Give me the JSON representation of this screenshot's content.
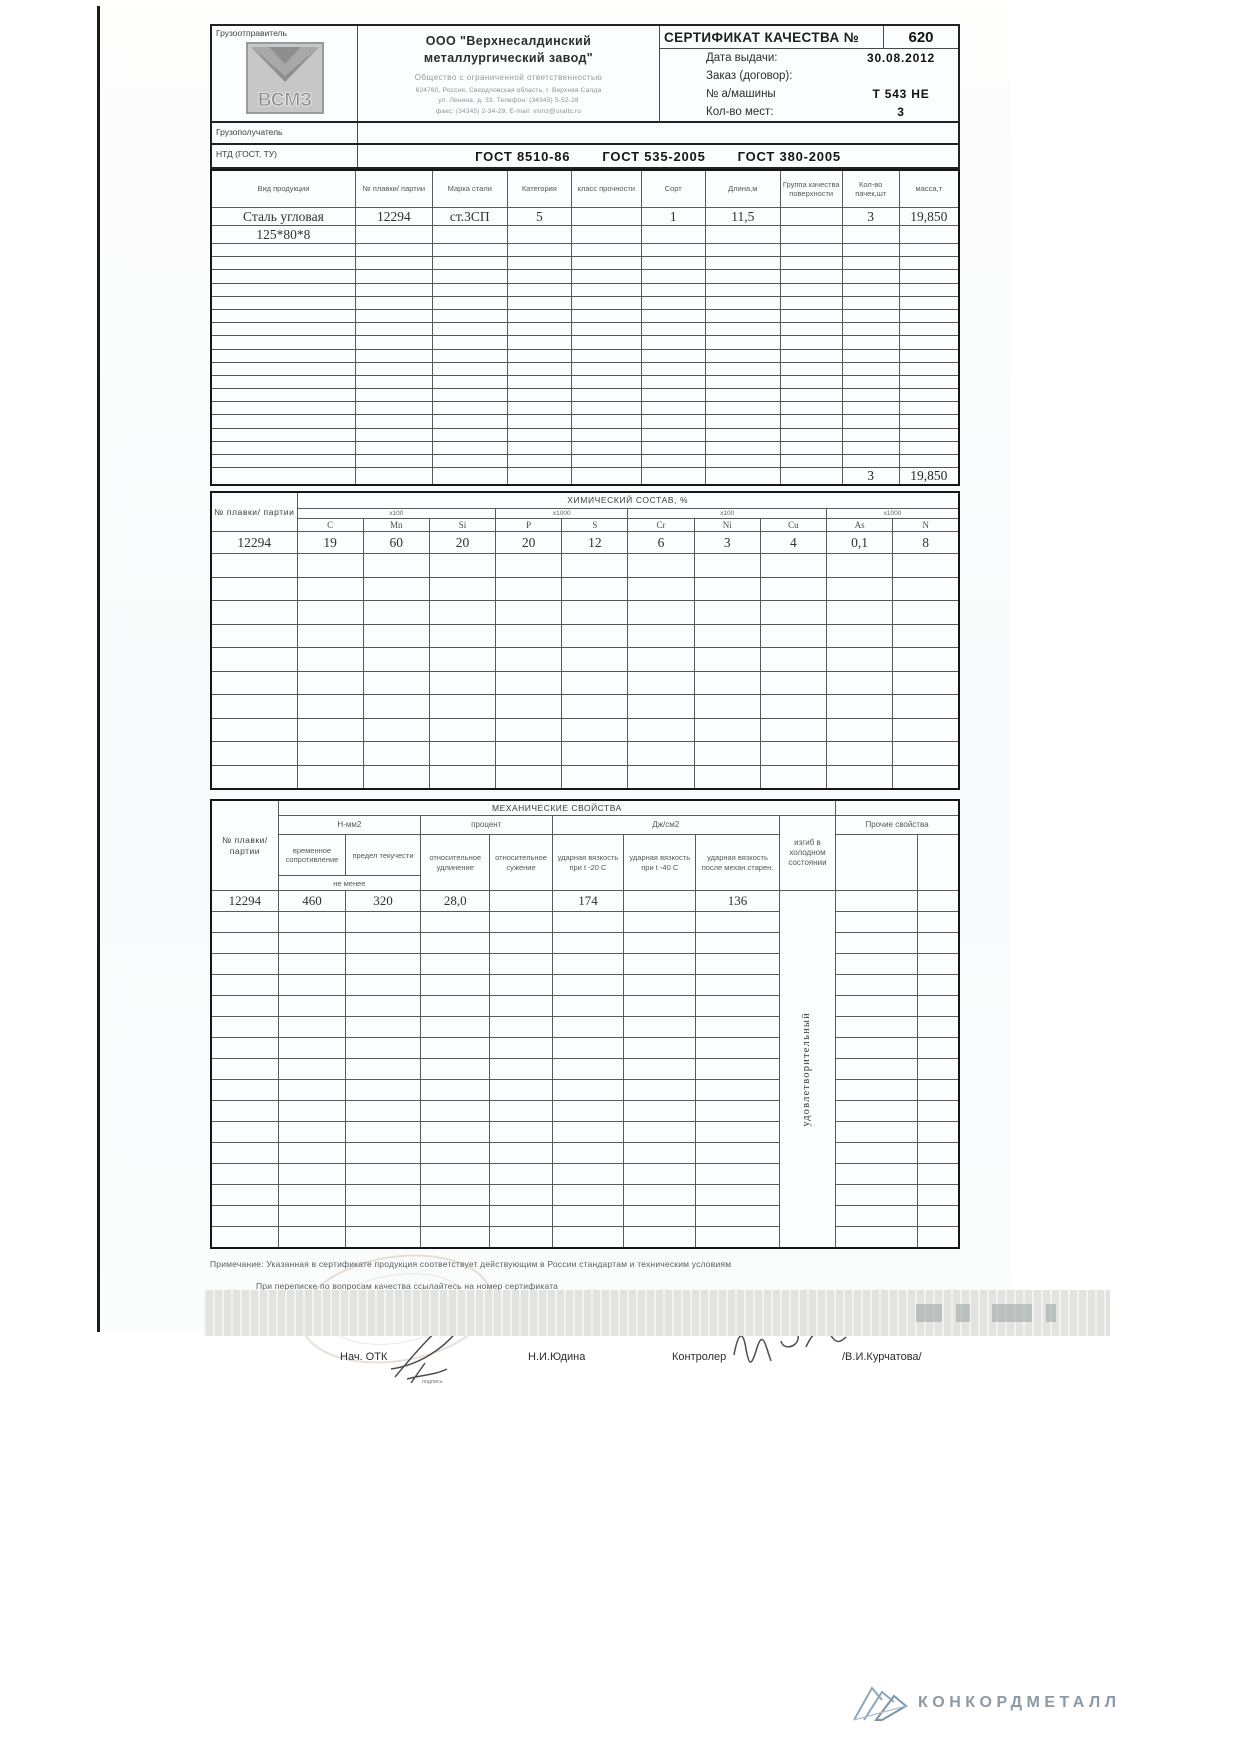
{
  "document": {
    "shipper_label": "Грузоотправитель",
    "logo_text": "ВСМЗ",
    "company": {
      "name1": "ООО \"Верхнесалдинский",
      "name2": "металлургический завод\"",
      "type": "Общество с ограниченной ответственностью",
      "addr1": "624760, Россия, Свердловская область, г. Верхняя Салда",
      "addr2": "ул. Ленина, д. 33. Телефон: (34345) 5-52-28",
      "addr3": "факс: (34345) 2-34-29, E-mail: vsmz@uraltc.ru"
    },
    "cert_title": "СЕРТИФИКАТ КАЧЕСТВА №",
    "cert_number": "620",
    "fields": [
      {
        "label": "Дата выдачи:",
        "value": "30.08.2012"
      },
      {
        "label": "Заказ (договор):",
        "value": ""
      },
      {
        "label": "№ а/машины",
        "value": "Т 543 НЕ"
      },
      {
        "label": "Кол-во мест:",
        "value": "3"
      }
    ],
    "consignee_label": "Грузополучатель",
    "ntd_label": "НТД (ГОСТ, ТУ)",
    "standards": [
      "ГОСТ 8510-86",
      "ГОСТ 535-2005",
      "ГОСТ 380-2005"
    ]
  },
  "product_table": {
    "columns": [
      "Вид продукции",
      "№ плавки/ партии",
      "Марка стали",
      "Категория",
      "класс прочности",
      "Сорт",
      "Длина,м",
      "Группа качества поверхности",
      "Кол-во пачек,шт",
      "масса,т"
    ],
    "rows": [
      [
        "Сталь угловая",
        "12294",
        "ст.3СП",
        "5",
        "",
        "1",
        "11,5",
        "",
        "3",
        "19,850"
      ],
      [
        "125*80*8",
        "",
        "",
        "",
        "",
        "",
        "",
        "",
        "",
        ""
      ]
    ],
    "empty_row_count": 17,
    "totals": {
      "packs": "3",
      "mass": "19,850"
    }
  },
  "chem_table": {
    "id_label": "№ плавки/ партии",
    "title": "ХИМИЧЕСКИЙ СОСТАВ, %",
    "groups": [
      "х100",
      "х1000",
      "х100",
      "х1000"
    ],
    "elements": [
      "C",
      "Mn",
      "Si",
      "P",
      "S",
      "Cr",
      "Ni",
      "Cu",
      "As",
      "N"
    ],
    "rows": [
      [
        "12294",
        "19",
        "60",
        "20",
        "20",
        "12",
        "6",
        "3",
        "4",
        "0,1",
        "8"
      ]
    ],
    "empty_row_count": 10
  },
  "mech_table": {
    "title": "МЕХАНИЧЕСКИЕ СВОЙСТВА",
    "id_label": "№ плавки/ партии",
    "group_nmm2": "Н-мм2",
    "group_percent": "процент",
    "group_j": "Дж/см2",
    "group_other": "Прочие свойства",
    "col_tensile": "временное сопротивление",
    "col_yield": "предел текучести",
    "not_less": "не менее",
    "col_elong": "относительное удлинение",
    "col_contr": "относительное сужение",
    "col_imp20": "ударная вязкость при t -20  С",
    "col_imp40": "ударная вязкость при t -40 С",
    "col_impaged": "ударная вязкость после механ.старен.",
    "col_bend": "изгиб в холодном состоянии",
    "row": [
      "12294",
      "460",
      "320",
      "28,0",
      "",
      "174",
      "",
      "136"
    ],
    "bend_result": "удовлетворительный",
    "empty_row_count": 16
  },
  "notes": {
    "line1": "Примечание:  Указанная в сертификате продукция соответствует действующим в России стандартам и техническим условиям",
    "line2": "При переписке по вопросам качества ссылайтесь на номер сертификата"
  },
  "signatures": {
    "left_label": "Нач. ОТК",
    "left_caption": "подпись",
    "left_name": "Н.И.Юдина",
    "right_label": "Контролер",
    "right_name": "/В.И.Курчатова/",
    "stamp_line1": "Для",
    "stamp_line2": "сертификатов"
  },
  "footer": {
    "brand": "КОНКОРДМЕТАЛЛ"
  }
}
